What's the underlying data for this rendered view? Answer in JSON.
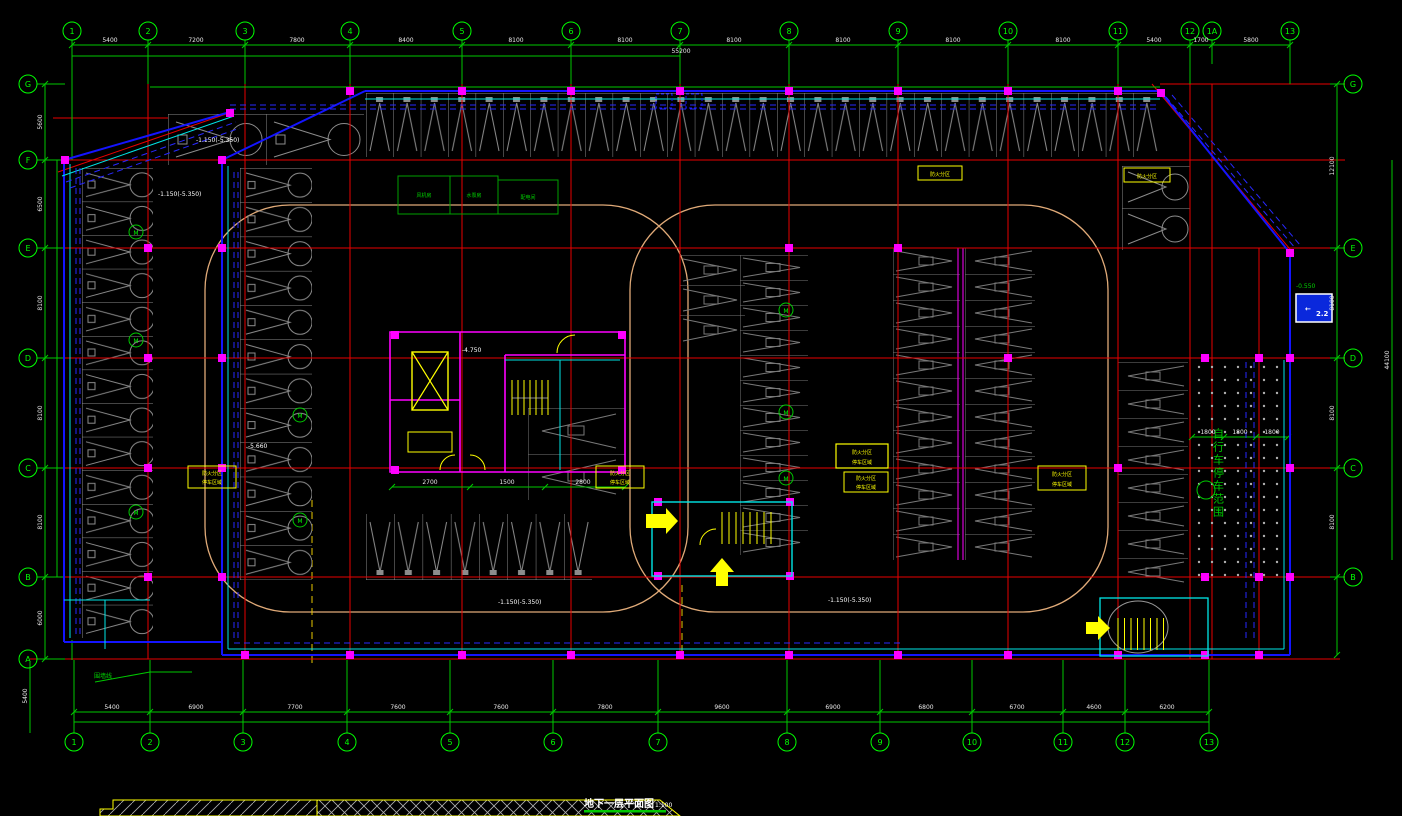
{
  "title": {
    "text": "地下一层平面图",
    "scale": "1:100"
  },
  "grid": {
    "top": [
      "1",
      "2",
      "3",
      "4",
      "5",
      "6",
      "7",
      "8",
      "9",
      "10",
      "11",
      "12",
      "1A",
      "13"
    ],
    "bottom": [
      "1",
      "2",
      "3",
      "4",
      "5",
      "6",
      "7",
      "8",
      "9",
      "10",
      "11",
      "12",
      "13"
    ],
    "left": [
      "G",
      "F",
      "E",
      "D",
      "C",
      "B",
      "A"
    ],
    "right": [
      "G",
      "E",
      "D",
      "C",
      "B"
    ]
  },
  "dims": {
    "top": [
      "5400",
      "7200",
      "7800",
      "8400",
      "8100",
      "8100",
      "8100",
      "8100",
      "8100",
      "8100",
      "5400",
      "1700",
      "5800"
    ],
    "top_total": "55200",
    "bottom": [
      "5400",
      "6900",
      "7700",
      "7600",
      "7600",
      "7800",
      "9600",
      "6900",
      "6800",
      "6700",
      "4600",
      "6200"
    ],
    "left": [
      "5600",
      "6500",
      "8100",
      "8100",
      "8100",
      "6000"
    ],
    "right": [
      "12100",
      "8100",
      "8100",
      "8100"
    ],
    "right_total": "44100",
    "left_outer": "5400",
    "bike": [
      "1800",
      "1800",
      "1800"
    ],
    "core": [
      "2700",
      "1500",
      "2800"
    ]
  },
  "ann": {
    "elev_a": "-1.150(-5.350)",
    "elev_b": "-1.150(-5.350)",
    "elev_c": "-1.150(-5.350)",
    "elev_d": "-1.150(-5.350)",
    "level_core": "-4.750",
    "level_pit": "-5.660",
    "level_sign": "-0.550",
    "fence": "围墙线",
    "bike_area": "自行车停车范围",
    "m": "M",
    "room1": "风机房",
    "room2": "水泵房",
    "room3": "配电间"
  },
  "box": {
    "l1": "防火分区",
    "l2": "停车区域"
  },
  "sign": {
    "arrow": "←",
    "text": "2.2"
  }
}
